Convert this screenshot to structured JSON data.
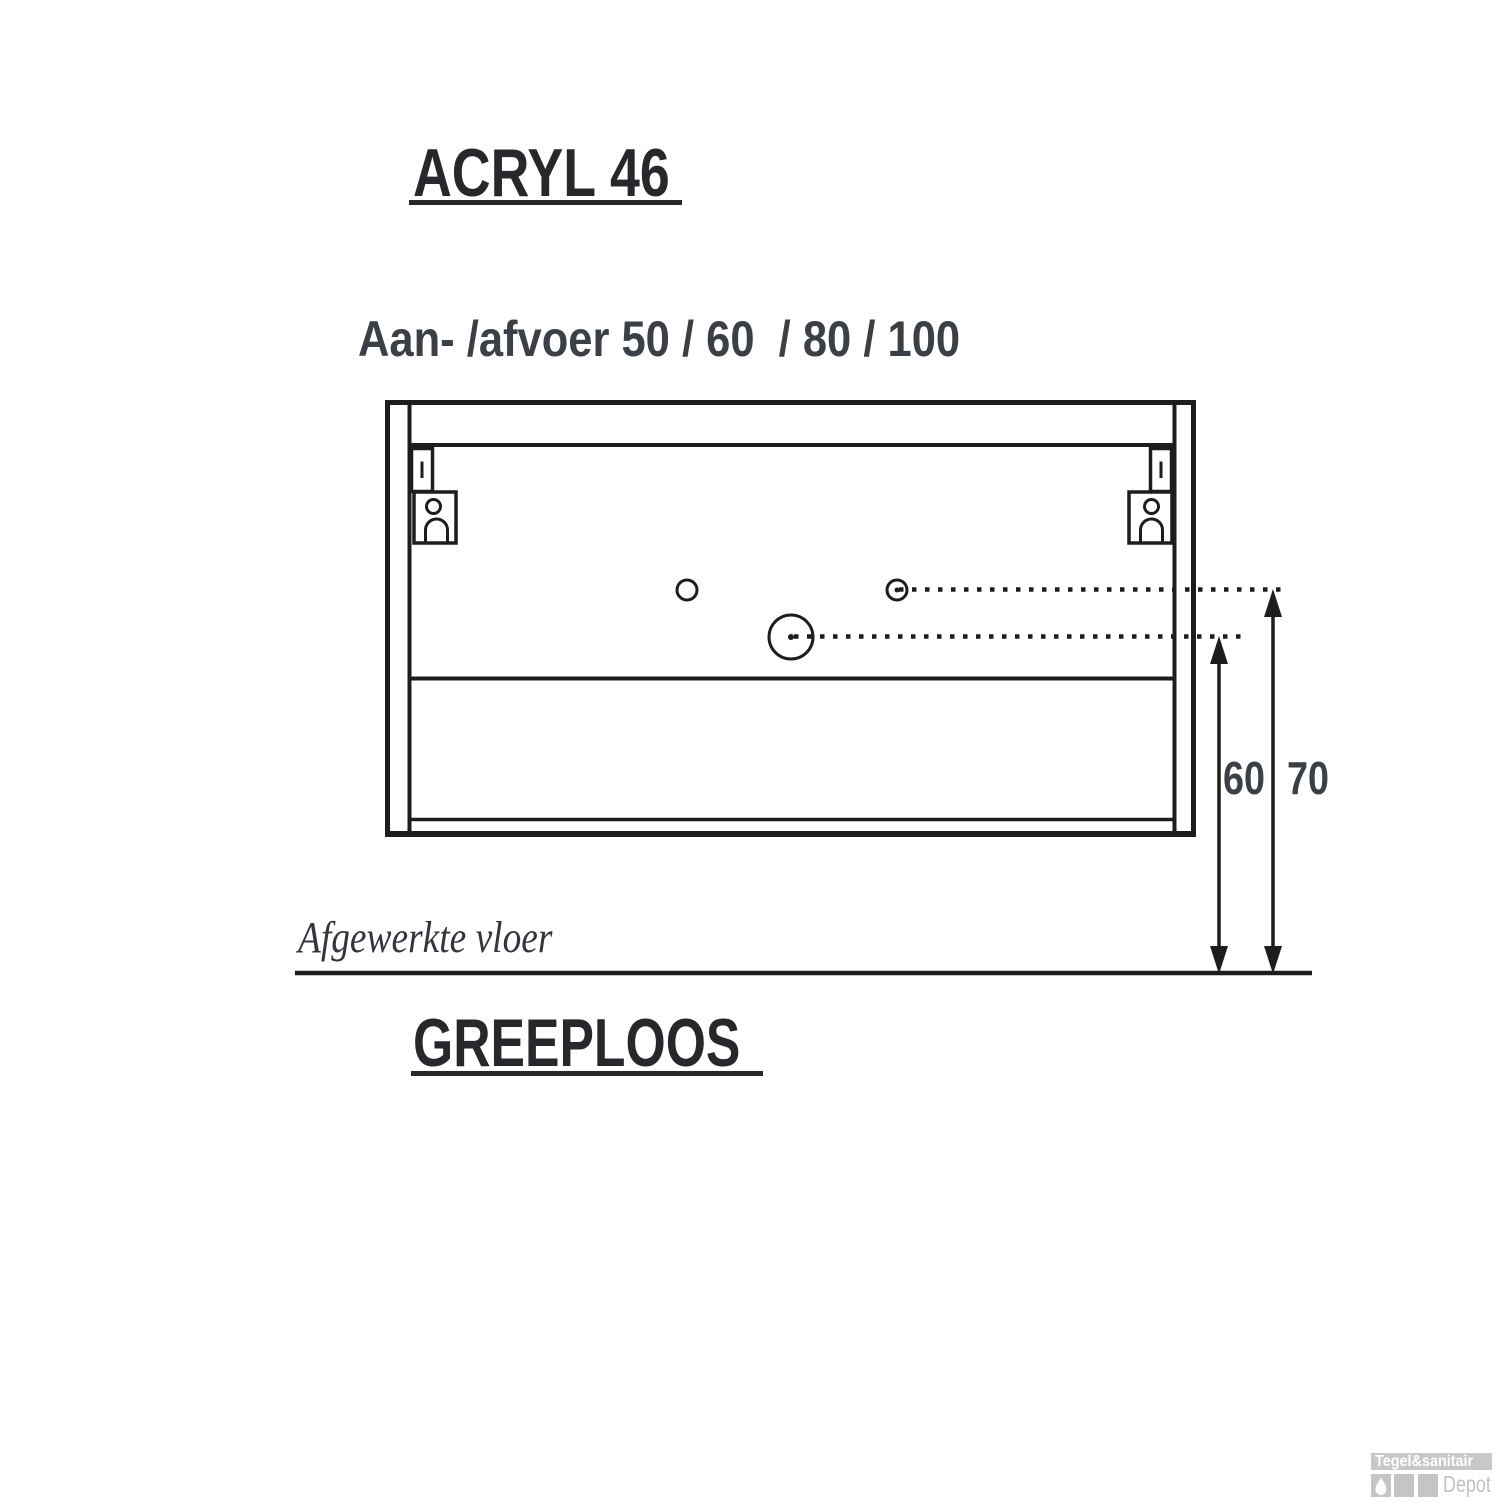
{
  "page": {
    "background": "#ffffff"
  },
  "title": {
    "text": "ACRYL 46"
  },
  "subtitle": {
    "text": "Aan- /afvoer 50 / 60  / 80 / 100"
  },
  "drawing": {
    "label_60": "60",
    "label_70": "70",
    "floor_label": "Afgewerkte vloer",
    "line_color": "#1d1d1b",
    "dim_text_color": "#3b4047",
    "title_text_color": "#26282c"
  },
  "footer": {
    "text": "GREEPLOOS"
  },
  "logo": {
    "brand": "Tegel&sanitair",
    "name": "Depot",
    "bar_color": "#c8c8c8",
    "square_color": "#c5c5c5",
    "brand_text_color": "#ffffff",
    "name_text_color": "#c2c2c2",
    "icon": "water-drop-icon"
  }
}
